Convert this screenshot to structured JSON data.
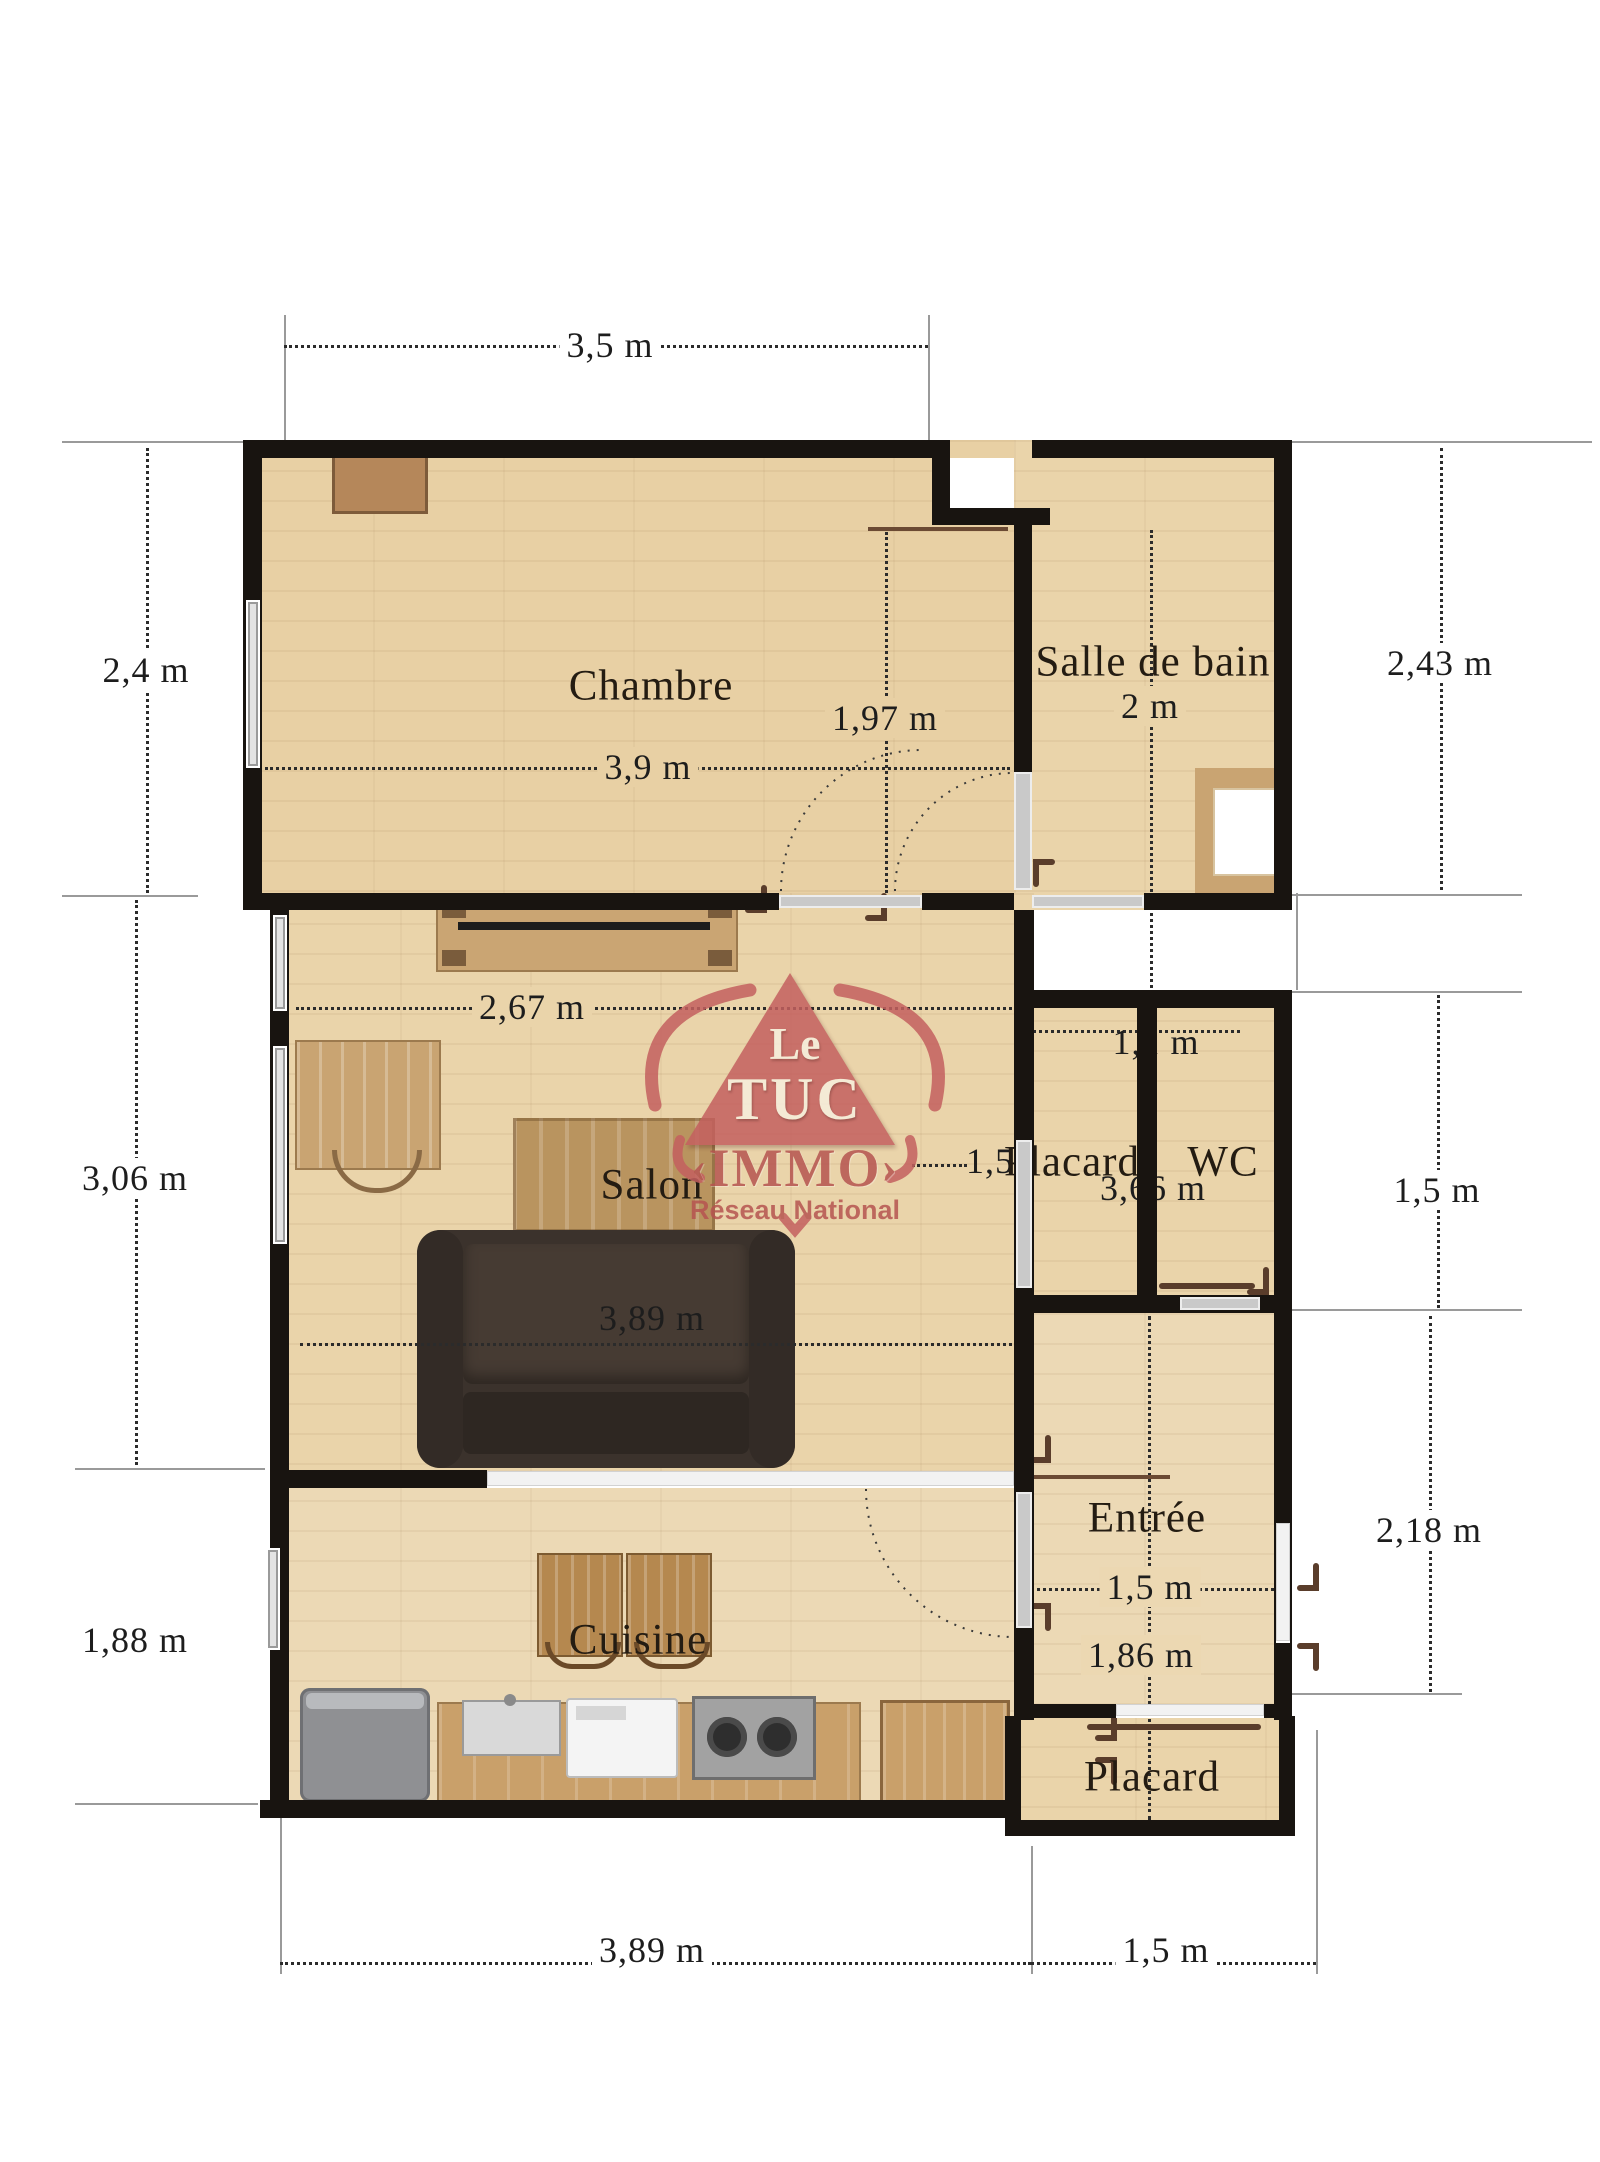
{
  "plan_title": "Floor plan",
  "brand": {
    "word1": "Le",
    "word2": "TUC",
    "word3": "IMMO",
    "bracket_left": "‹",
    "bracket_right": "›",
    "tagline": "Réseau National",
    "color": "#c4605f"
  },
  "rooms": [
    {
      "id": "chambre",
      "label": "Chambre"
    },
    {
      "id": "salle-de-bain",
      "label": "Salle de bain"
    },
    {
      "id": "salon",
      "label": "Salon"
    },
    {
      "id": "placard-milieu",
      "label": "Placard"
    },
    {
      "id": "wc",
      "label": "WC"
    },
    {
      "id": "entree",
      "label": "Entrée"
    },
    {
      "id": "cuisine",
      "label": "Cuisine"
    },
    {
      "id": "placard-bas",
      "label": "Placard"
    }
  ],
  "dimensions": [
    {
      "id": "top-width",
      "label": "3,5 m"
    },
    {
      "id": "chambre-height",
      "label": "2,4 m"
    },
    {
      "id": "sdb-height",
      "label": "2,43 m"
    },
    {
      "id": "chambre-inner-vertical",
      "label": "1,97 m"
    },
    {
      "id": "chambre-inner-width",
      "label": "3,9 m"
    },
    {
      "id": "sdb-inner",
      "label": "2 m"
    },
    {
      "id": "salon-upper-width",
      "label": "2,67 m"
    },
    {
      "id": "salon-height",
      "label": "3,06 m"
    },
    {
      "id": "salon-lower-width",
      "label": "3,89 m"
    },
    {
      "id": "placard-wc-width",
      "label": "1,1 m"
    },
    {
      "id": "placard-left",
      "label": "1,5"
    },
    {
      "id": "placard-wc-column",
      "label": "3,66 m"
    },
    {
      "id": "wc-height-right",
      "label": "1,5 m"
    },
    {
      "id": "entree-height-right",
      "label": "2,18 m"
    },
    {
      "id": "entree-width",
      "label": "1,5 m"
    },
    {
      "id": "entree-inner-height",
      "label": "1,86 m"
    },
    {
      "id": "cuisine-height",
      "label": "1,88 m"
    },
    {
      "id": "bottom-left-width",
      "label": "3,89 m"
    },
    {
      "id": "bottom-right-width",
      "label": "1,5 m"
    }
  ],
  "colors": {
    "wall": "#181410",
    "floor": "#ead4aa",
    "dimension_text": "#1d1d1d",
    "logo_red": "#c4605f"
  }
}
